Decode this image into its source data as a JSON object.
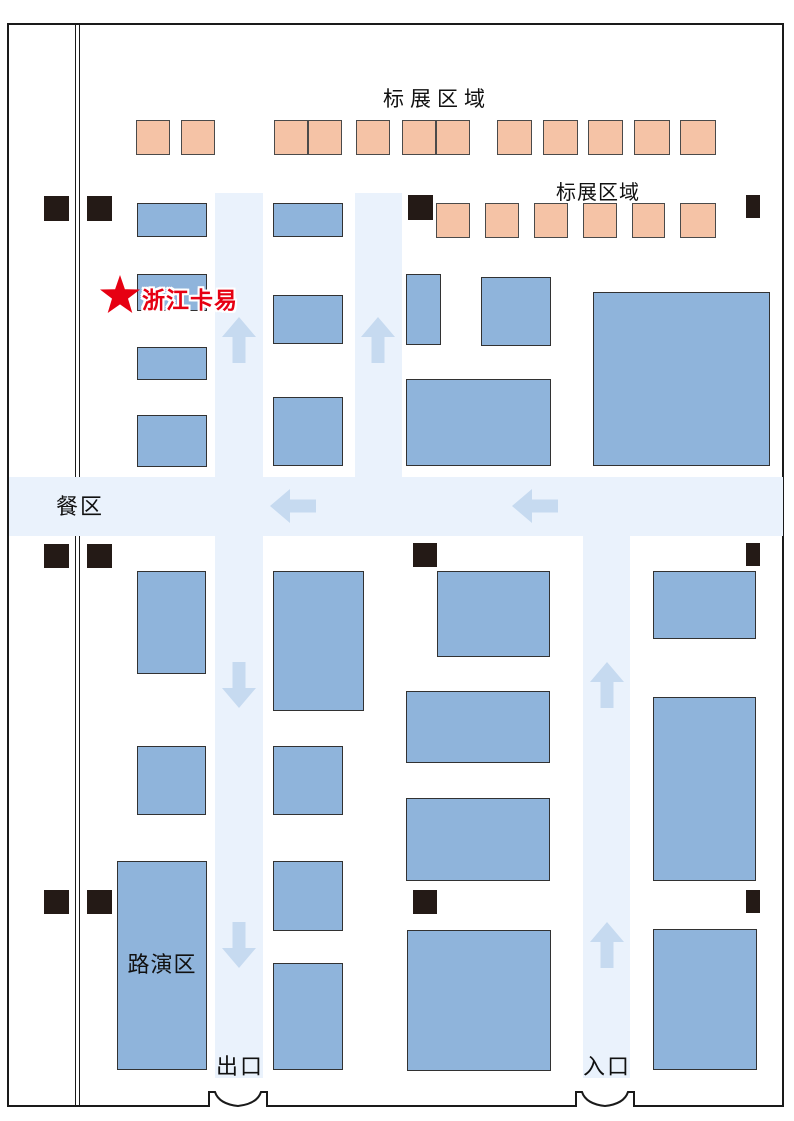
{
  "map": {
    "labels": {
      "standard_area_top": "标展区域",
      "standard_area_right": "标展区域",
      "dining_area": "餐区",
      "roadshow_area": "路演区",
      "exit": "出口",
      "entrance": "入口",
      "highlight_company": "浙江卡易"
    },
    "colors": {
      "wall": "#1A1A1A",
      "aisle": "#EAF2FC",
      "arrow": "#C6DAF0",
      "standard_booth": "#F5C3A6",
      "exhibitor_booth": "#8FB4DB",
      "pillar": "#241A16",
      "highlight": "#E60012"
    },
    "geometry": {
      "aisles": [
        [
          215,
          193,
          48,
          284
        ],
        [
          355,
          193,
          47,
          284
        ],
        [
          9,
          477,
          774,
          59
        ],
        [
          215,
          536,
          48,
          542
        ],
        [
          583,
          536,
          47,
          542
        ]
      ],
      "standard_booths": [
        [
          136,
          120,
          34,
          35
        ],
        [
          181,
          120,
          34,
          35
        ],
        [
          274,
          120,
          34,
          35
        ],
        [
          308,
          120,
          34,
          35
        ],
        [
          356,
          120,
          34,
          35
        ],
        [
          402,
          120,
          34,
          35
        ],
        [
          436,
          120,
          34,
          35
        ],
        [
          497,
          120,
          35,
          35
        ],
        [
          543,
          120,
          35,
          35
        ],
        [
          588,
          120,
          35,
          35
        ],
        [
          634,
          120,
          36,
          35
        ],
        [
          680,
          120,
          36,
          35
        ],
        [
          436,
          203,
          34,
          35
        ],
        [
          485,
          203,
          34,
          35
        ],
        [
          534,
          203,
          34,
          35
        ],
        [
          583,
          203,
          34,
          35
        ],
        [
          632,
          203,
          33,
          35
        ],
        [
          680,
          203,
          36,
          35
        ]
      ],
      "exhibitor_booths": [
        [
          137,
          203,
          70,
          34
        ],
        [
          273,
          203,
          70,
          34
        ],
        [
          137,
          274,
          70,
          37
        ],
        [
          406,
          274,
          35,
          71
        ],
        [
          481,
          277,
          70,
          69
        ],
        [
          273,
          295,
          70,
          49
        ],
        [
          593,
          292,
          177,
          174
        ],
        [
          137,
          347,
          70,
          33
        ],
        [
          406,
          379,
          145,
          87
        ],
        [
          273,
          397,
          70,
          69
        ],
        [
          137,
          415,
          70,
          52
        ],
        [
          137,
          571,
          69,
          103
        ],
        [
          273,
          571,
          91,
          140
        ],
        [
          437,
          571,
          113,
          86
        ],
        [
          653,
          571,
          103,
          68
        ],
        [
          406,
          691,
          144,
          72
        ],
        [
          653,
          697,
          103,
          184
        ],
        [
          137,
          746,
          69,
          69
        ],
        [
          273,
          746,
          70,
          69
        ],
        [
          406,
          798,
          144,
          83
        ],
        [
          117,
          861,
          90,
          209
        ],
        [
          273,
          861,
          70,
          70
        ],
        [
          407,
          930,
          144,
          141
        ],
        [
          653,
          929,
          104,
          141
        ],
        [
          273,
          963,
          70,
          107
        ]
      ],
      "pillars": [
        [
          44,
          196,
          25,
          25
        ],
        [
          87,
          196,
          25,
          25
        ],
        [
          408,
          195,
          25,
          25
        ],
        [
          746,
          195,
          14,
          23
        ],
        [
          44,
          544,
          25,
          24
        ],
        [
          87,
          544,
          25,
          24
        ],
        [
          413,
          543,
          24,
          24
        ],
        [
          746,
          543,
          14,
          23
        ],
        [
          44,
          890,
          25,
          24
        ],
        [
          87,
          890,
          25,
          24
        ],
        [
          413,
          890,
          24,
          24
        ],
        [
          746,
          890,
          14,
          23
        ]
      ],
      "arrows": [
        {
          "d": "up",
          "x": 239,
          "y": 340
        },
        {
          "d": "up",
          "x": 378,
          "y": 340
        },
        {
          "d": "left",
          "x": 293,
          "y": 506
        },
        {
          "d": "left",
          "x": 535,
          "y": 506
        },
        {
          "d": "down",
          "x": 239,
          "y": 685
        },
        {
          "d": "up",
          "x": 607,
          "y": 685
        },
        {
          "d": "down",
          "x": 239,
          "y": 945
        },
        {
          "d": "up",
          "x": 607,
          "y": 945
        }
      ]
    }
  }
}
